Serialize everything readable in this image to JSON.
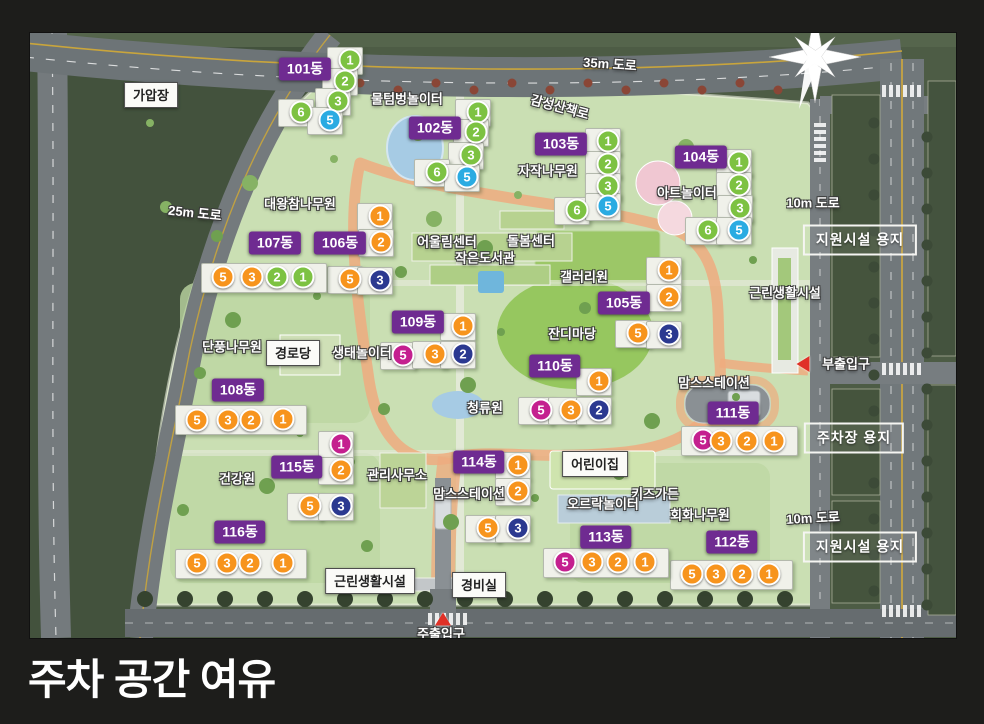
{
  "title": "주차 공간 여유",
  "colors": {
    "green": "#7dc242",
    "blue": "#2aabe2",
    "orange": "#f7941d",
    "pink": "#c4208f",
    "navy": "#2b3990",
    "badge_purple": "#6f2b91",
    "entrance_red": "#e03127"
  },
  "map": {
    "buildings": [
      {
        "name": "101동",
        "shape": "tower",
        "badge": {
          "x": 305,
          "y": 69
        },
        "units": [
          {
            "n": "1",
            "color": "green",
            "x": 350,
            "y": 60
          },
          {
            "n": "2",
            "color": "green",
            "x": 345,
            "y": 81
          },
          {
            "n": "3",
            "color": "green",
            "x": 338,
            "y": 101
          },
          {
            "n": "6",
            "color": "green",
            "x": 301,
            "y": 112
          },
          {
            "n": "5",
            "color": "blue",
            "x": 330,
            "y": 120
          }
        ]
      },
      {
        "name": "102동",
        "shape": "tower",
        "badge": {
          "x": 435,
          "y": 128
        },
        "units": [
          {
            "n": "1",
            "color": "green",
            "x": 478,
            "y": 112
          },
          {
            "n": "2",
            "color": "green",
            "x": 476,
            "y": 132
          },
          {
            "n": "3",
            "color": "green",
            "x": 471,
            "y": 155
          },
          {
            "n": "6",
            "color": "green",
            "x": 437,
            "y": 172
          },
          {
            "n": "5",
            "color": "blue",
            "x": 467,
            "y": 177
          }
        ]
      },
      {
        "name": "103동",
        "shape": "tower",
        "badge": {
          "x": 561,
          "y": 144
        },
        "units": [
          {
            "n": "1",
            "color": "green",
            "x": 608,
            "y": 141
          },
          {
            "n": "2",
            "color": "green",
            "x": 608,
            "y": 164
          },
          {
            "n": "3",
            "color": "green",
            "x": 608,
            "y": 186
          },
          {
            "n": "6",
            "color": "green",
            "x": 577,
            "y": 210
          },
          {
            "n": "5",
            "color": "blue",
            "x": 608,
            "y": 206
          }
        ]
      },
      {
        "name": "104동",
        "shape": "tower",
        "badge": {
          "x": 701,
          "y": 157
        },
        "units": [
          {
            "n": "1",
            "color": "green",
            "x": 739,
            "y": 162
          },
          {
            "n": "2",
            "color": "green",
            "x": 739,
            "y": 185
          },
          {
            "n": "3",
            "color": "green",
            "x": 740,
            "y": 208
          },
          {
            "n": "6",
            "color": "green",
            "x": 708,
            "y": 230
          },
          {
            "n": "5",
            "color": "blue",
            "x": 739,
            "y": 230
          }
        ]
      },
      {
        "name": "105동",
        "shape": "tower",
        "badge": {
          "x": 624,
          "y": 303
        },
        "units": [
          {
            "n": "1",
            "color": "orange",
            "x": 669,
            "y": 270
          },
          {
            "n": "2",
            "color": "orange",
            "x": 669,
            "y": 297
          },
          {
            "n": "5",
            "color": "orange",
            "x": 638,
            "y": 333
          },
          {
            "n": "3",
            "color": "navy",
            "x": 669,
            "y": 334
          }
        ]
      },
      {
        "name": "106동",
        "shape": "tower",
        "badge": {
          "x": 340,
          "y": 243
        },
        "units": [
          {
            "n": "1",
            "color": "orange",
            "x": 380,
            "y": 216
          },
          {
            "n": "2",
            "color": "orange",
            "x": 381,
            "y": 242
          },
          {
            "n": "5",
            "color": "orange",
            "x": 350,
            "y": 279
          },
          {
            "n": "3",
            "color": "navy",
            "x": 380,
            "y": 280
          }
        ]
      },
      {
        "name": "107동",
        "shape": "row",
        "badge": {
          "x": 275,
          "y": 243
        },
        "units": [
          {
            "n": "5",
            "color": "orange",
            "x": 223,
            "y": 277
          },
          {
            "n": "3",
            "color": "orange",
            "x": 252,
            "y": 277
          },
          {
            "n": "2",
            "color": "green",
            "x": 277,
            "y": 277
          },
          {
            "n": "1",
            "color": "green",
            "x": 303,
            "y": 277
          }
        ]
      },
      {
        "name": "108동",
        "shape": "row",
        "badge": {
          "x": 238,
          "y": 390
        },
        "units": [
          {
            "n": "5",
            "color": "orange",
            "x": 197,
            "y": 420
          },
          {
            "n": "3",
            "color": "orange",
            "x": 228,
            "y": 420
          },
          {
            "n": "2",
            "color": "orange",
            "x": 251,
            "y": 420
          },
          {
            "n": "1",
            "color": "orange",
            "x": 283,
            "y": 419
          }
        ]
      },
      {
        "name": "109동",
        "shape": "tower",
        "badge": {
          "x": 418,
          "y": 322
        },
        "units": [
          {
            "n": "1",
            "color": "orange",
            "x": 463,
            "y": 326
          },
          {
            "n": "5",
            "color": "pink",
            "x": 403,
            "y": 355
          },
          {
            "n": "3",
            "color": "orange",
            "x": 435,
            "y": 354
          },
          {
            "n": "2",
            "color": "navy",
            "x": 463,
            "y": 354
          }
        ]
      },
      {
        "name": "110동",
        "shape": "tower",
        "badge": {
          "x": 555,
          "y": 366
        },
        "units": [
          {
            "n": "1",
            "color": "orange",
            "x": 599,
            "y": 381
          },
          {
            "n": "5",
            "color": "pink",
            "x": 541,
            "y": 410
          },
          {
            "n": "3",
            "color": "orange",
            "x": 571,
            "y": 410
          },
          {
            "n": "2",
            "color": "navy",
            "x": 599,
            "y": 410
          }
        ]
      },
      {
        "name": "111동",
        "shape": "row",
        "badge": {
          "x": 733,
          "y": 413
        },
        "units": [
          {
            "n": "5",
            "color": "pink",
            "x": 703,
            "y": 440
          },
          {
            "n": "3",
            "color": "orange",
            "x": 721,
            "y": 441
          },
          {
            "n": "2",
            "color": "orange",
            "x": 747,
            "y": 441
          },
          {
            "n": "1",
            "color": "orange",
            "x": 774,
            "y": 441
          }
        ]
      },
      {
        "name": "112동",
        "shape": "row",
        "badge": {
          "x": 732,
          "y": 542
        },
        "units": [
          {
            "n": "5",
            "color": "orange",
            "x": 692,
            "y": 574
          },
          {
            "n": "3",
            "color": "orange",
            "x": 716,
            "y": 574
          },
          {
            "n": "2",
            "color": "orange",
            "x": 742,
            "y": 574
          },
          {
            "n": "1",
            "color": "orange",
            "x": 769,
            "y": 574
          }
        ]
      },
      {
        "name": "113동",
        "shape": "row",
        "badge": {
          "x": 606,
          "y": 537
        },
        "units": [
          {
            "n": "5",
            "color": "pink",
            "x": 565,
            "y": 562
          },
          {
            "n": "3",
            "color": "orange",
            "x": 592,
            "y": 562
          },
          {
            "n": "2",
            "color": "orange",
            "x": 618,
            "y": 562
          },
          {
            "n": "1",
            "color": "orange",
            "x": 645,
            "y": 562
          }
        ]
      },
      {
        "name": "114동",
        "shape": "tower",
        "badge": {
          "x": 479,
          "y": 462
        },
        "units": [
          {
            "n": "1",
            "color": "orange",
            "x": 518,
            "y": 465
          },
          {
            "n": "2",
            "color": "orange",
            "x": 518,
            "y": 491
          },
          {
            "n": "5",
            "color": "orange",
            "x": 488,
            "y": 528
          },
          {
            "n": "3",
            "color": "navy",
            "x": 518,
            "y": 528
          }
        ]
      },
      {
        "name": "115동",
        "shape": "tower",
        "badge": {
          "x": 297,
          "y": 467
        },
        "units": [
          {
            "n": "1",
            "color": "pink",
            "x": 341,
            "y": 444
          },
          {
            "n": "2",
            "color": "orange",
            "x": 341,
            "y": 470
          },
          {
            "n": "5",
            "color": "orange",
            "x": 310,
            "y": 506
          },
          {
            "n": "3",
            "color": "navy",
            "x": 341,
            "y": 506
          }
        ]
      },
      {
        "name": "116동",
        "shape": "row",
        "badge": {
          "x": 240,
          "y": 532
        },
        "units": [
          {
            "n": "5",
            "color": "orange",
            "x": 197,
            "y": 563
          },
          {
            "n": "3",
            "color": "orange",
            "x": 227,
            "y": 563
          },
          {
            "n": "2",
            "color": "orange",
            "x": 250,
            "y": 563
          },
          {
            "n": "1",
            "color": "orange",
            "x": 283,
            "y": 563
          }
        ]
      }
    ],
    "labels": [
      {
        "text": "가압장",
        "style": "box",
        "x": 151,
        "y": 95
      },
      {
        "text": "경로당",
        "style": "box",
        "x": 293,
        "y": 353
      },
      {
        "text": "어린이집",
        "style": "box",
        "x": 595,
        "y": 464
      },
      {
        "text": "근린생활시설",
        "style": "box",
        "x": 370,
        "y": 581
      },
      {
        "text": "경비실",
        "style": "box",
        "x": 479,
        "y": 585
      },
      {
        "text": "지원시설 용지",
        "style": "zone",
        "x": 860,
        "y": 240
      },
      {
        "text": "주차장 용지",
        "style": "zone",
        "x": 854,
        "y": 438
      },
      {
        "text": "지원시설 용지",
        "style": "zone",
        "x": 860,
        "y": 547
      },
      {
        "text": "물텀벙놀이터",
        "style": "outline",
        "x": 407,
        "y": 98
      },
      {
        "text": "감성산책로",
        "style": "outline",
        "x": 560,
        "y": 106,
        "rotate": 15
      },
      {
        "text": "자작나무원",
        "style": "outline",
        "x": 548,
        "y": 170
      },
      {
        "text": "아트놀이터",
        "style": "outline",
        "x": 687,
        "y": 192
      },
      {
        "text": "대왕참나무원",
        "style": "outline",
        "x": 300,
        "y": 203
      },
      {
        "text": "어울림센터",
        "style": "outline",
        "x": 447,
        "y": 241
      },
      {
        "text": "돌봄센터",
        "style": "outline",
        "x": 531,
        "y": 240
      },
      {
        "text": "작은도서관",
        "style": "outline",
        "x": 485,
        "y": 257
      },
      {
        "text": "갤러리원",
        "style": "outline",
        "x": 584,
        "y": 276
      },
      {
        "text": "근린생활시설",
        "style": "outline",
        "x": 785,
        "y": 292
      },
      {
        "text": "단풍나무원",
        "style": "outline",
        "x": 232,
        "y": 346
      },
      {
        "text": "잔디마당",
        "style": "outline",
        "x": 572,
        "y": 333
      },
      {
        "text": "생태놀이터",
        "style": "outline",
        "x": 362,
        "y": 352
      },
      {
        "text": "맘스스테이션",
        "style": "outline",
        "x": 714,
        "y": 382
      },
      {
        "text": "청류원",
        "style": "outline",
        "x": 485,
        "y": 407
      },
      {
        "text": "건강원",
        "style": "outline",
        "x": 237,
        "y": 478
      },
      {
        "text": "관리사무소",
        "style": "outline",
        "x": 397,
        "y": 474
      },
      {
        "text": "맘스스테이션",
        "style": "outline",
        "x": 469,
        "y": 493
      },
      {
        "text": "키즈가든",
        "style": "outline",
        "x": 655,
        "y": 493
      },
      {
        "text": "오르락놀이터",
        "style": "outline",
        "x": 603,
        "y": 503
      },
      {
        "text": "회화나무원",
        "style": "outline",
        "x": 700,
        "y": 514
      },
      {
        "text": "35m 도로",
        "style": "road",
        "x": 610,
        "y": 63,
        "rotate": 4
      },
      {
        "text": "25m 도로",
        "style": "road",
        "x": 195,
        "y": 212,
        "rotate": 6
      },
      {
        "text": "10m 도로",
        "style": "road",
        "x": 813,
        "y": 202
      },
      {
        "text": "10m 도로",
        "style": "road",
        "x": 813,
        "y": 517,
        "rotate": -3
      }
    ],
    "entrances": [
      {
        "text": "부출입구",
        "arrow": "left",
        "x": 846,
        "y": 363,
        "ax": 803,
        "ay": 364
      },
      {
        "text": "주출입구",
        "arrow": "up",
        "x": 441,
        "y": 633,
        "ax": 443,
        "ay": 619
      }
    ],
    "compass_name": "north-compass"
  }
}
